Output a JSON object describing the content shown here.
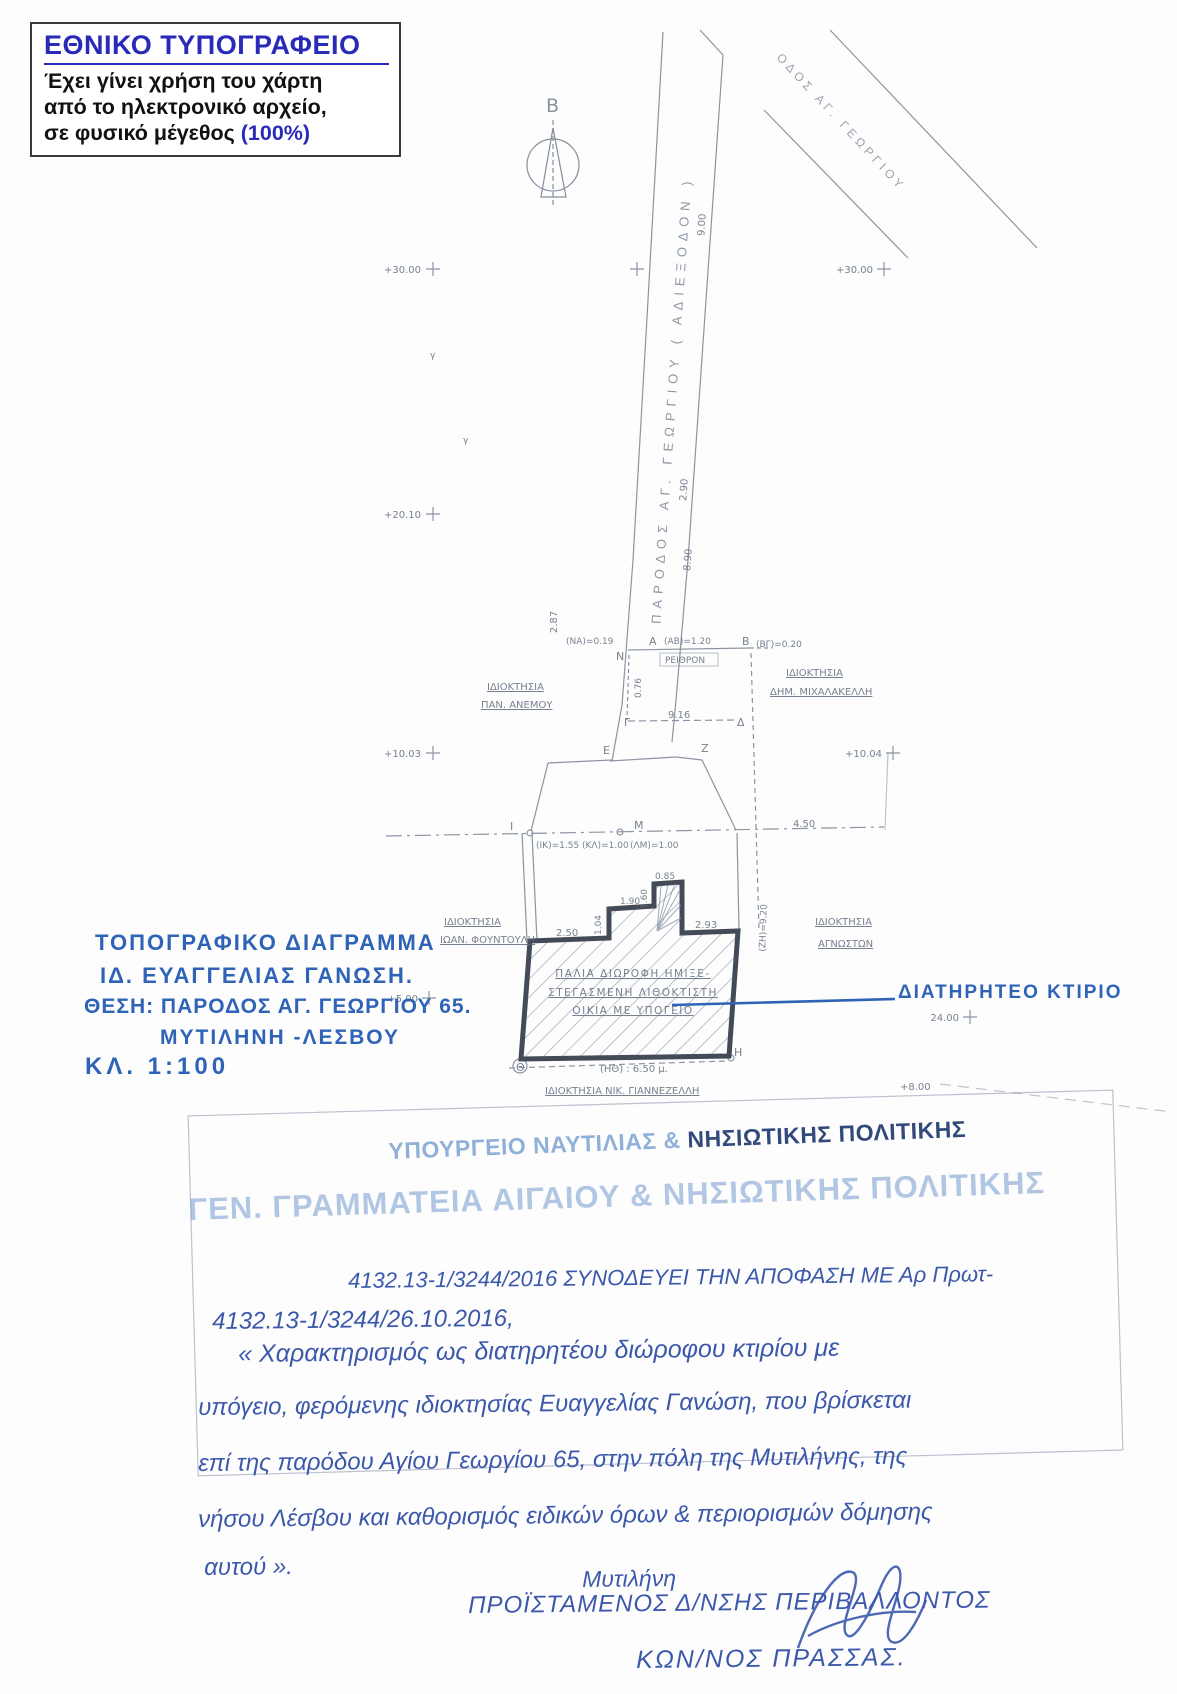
{
  "colors": {
    "header_blue": "#2a2ab8",
    "marker_blue": "#2e63b8",
    "ink_blue": "#3b58ab",
    "pencil_gray": "#6e7a8c",
    "stamp_faded": "#8fb0d8",
    "stamp_dark": "#32497b"
  },
  "header_box": {
    "title": "ΕΘΝΙΚΟ ΤΥΠΟΓΡΑΦΕΙΟ",
    "line1": "Έχει γίνει χρήση του χάρτη",
    "line2": "από το ηλεκτρονικό αρχείο,",
    "line3": "σε φυσικό μέγεθος ",
    "line3_highlight": "(100%)"
  },
  "north": {
    "label": "Β"
  },
  "drawing": {
    "road_main_label": "ΠΑΡΟΔΟΣ  ΑΓ. ΓΕΩΡΓΙΟΥ  ( ΑΔΙΕΞΟΔΟΝ )",
    "cross_road_label": "ΟΔΟΣ  ΑΓ. ΓΕΩΡΓΙΟΥ",
    "gutter_label": "ΡΕΙΘΡΟΝ",
    "owners": {
      "anemou_1": "ΙΔΙΟΚΤΗΣΙΑ",
      "anemou_2": "ΠΑΝ. ΑΝΕΜΟΥ",
      "michalakelli_1": "ΙΔΙΟΚΤΗΣΙΑ",
      "michalakelli_2": "ΔΗΜ. ΜΙΧΑΛΑΚΕΛΛΗ",
      "fountouli_1": "ΙΔΙΟΚΤΗΣΙΑ",
      "fountouli_2": "ΙΩΑΝ. ΦΟΥΝΤΟΥΛΗ",
      "agnoston_1": "ΙΔΙΟΚΤΗΣΙΑ",
      "agnoston_2": "ΑΓΝΩΣΤΩΝ",
      "giannezelli": "ΙΔΙΟΚΤΗΣΙΑ ΝΙΚ. ΓΙΑΝΝΕΖΕΛΛΗ"
    },
    "building_label_1": "ΠΑΛΙΑ ΔΙΩΡΟΦΗ ΗΜΙΞΕ-",
    "building_label_2": "ΣΤΕΓΑΣΜΕΝΗ ΛΙΘΟΚΤΙΣΤΗ",
    "building_label_3": "ΟΙΚΙΑ ΜΕ ΥΠΟΓΕΙΟ",
    "elevations": {
      "top_left": "+30.00",
      "top_right": "+30.00",
      "mid_left": "+20.10",
      "low_left": "+10.03",
      "low_right": "+10.04",
      "bottom_left": "+5.00",
      "bottom_right": "24.00",
      "far_right": "+8.00"
    },
    "points": {
      "n": "Ν",
      "a": "Α",
      "b": "Β",
      "g": "Γ",
      "d": "Δ",
      "e": "Ε",
      "z": "Ζ",
      "h": "Η",
      "th": "Θ",
      "i": "Ι",
      "m": "Μ"
    },
    "dims": {
      "w900": "9.00",
      "w290": "2.90",
      "w890": "8.90",
      "w287": "2.87",
      "w076": "0.76",
      "na": "(ΝΑ)=0.19",
      "ab": "(ΑΒ)=1.20",
      "bg": "(ΒΓ)=0.20",
      "w916": "9.16",
      "ik": "(ΙΚ)=1.55 (ΚΛ)=1.00",
      "lm": "(ΛΜ)=1.00",
      "w450": "4.50",
      "w250": "2.50",
      "w104": "1.04",
      "w190": "1.90",
      "w160": "1.60",
      "w085": "0.85",
      "w293": "2.93",
      "zh": "(ΖΗ)=9.20",
      "hth": "(ΗΘ) : 6.50 μ."
    }
  },
  "annotation": {
    "preserved_building": "ΔΙΑΤΗΡΗΤΕΟ ΚΤΙΡΙΟ"
  },
  "title_block": {
    "line1": "ΤΟΠΟΓΡΑΦΙΚΟ ΔΙΑΓΡΑΜΜΑ",
    "line2": "ΙΔ. ΕΥΑΓΓΕΛΙΑΣ ΓΑΝΩΣΗ.",
    "line3": "ΘΕΣΗ: ΠΑΡΟΔΟΣ ΑΓ. ΓΕΩΡΓΙΟΥ 65.",
    "line4": "ΜΥΤΙΛΗΝΗ -ΛΕΣΒΟΥ",
    "line5": "ΚΛ. 1:100"
  },
  "stamp": {
    "ministry_faded": "ΥΠΟΥΡΓΕΙΟ ΝΑΥΤΙΛΙΑΣ & ",
    "ministry_dark": "ΝΗΣΙΩΤΙΚΗΣ ΠΟΛΙΤΙΚΗΣ",
    "secretariat": "ΓΕΝ. ΓΡΑΜΜΑΤΕΙΑ ΑΙΓΑΙΟΥ & ΝΗΣΙΩΤΙΚΗΣ ΠΟΛΙΤΙΚΗΣ"
  },
  "handwritten": {
    "line1": "4132.13-1/3244/2016  ΣΥΝΟΔΕΥΕΙ ΤΗΝ ΑΠΟΦΑΣΗ ΜΕ Αρ Πρωτ-",
    "line2": "4132.13-1/3244/26.10.2016,",
    "line3": "« Χαρακτηρισμός ως διατηρητέου διώροφου κτιρίου με",
    "line4": "υπόγειο, φερόμενης ιδιοκτησίας Ευαγγελίας Γανώση, που βρίσκεται",
    "line5": "επί της παρόδου Αγίου Γεωργίου 65, στην πόλη της Μυτιλήνης, της",
    "line6": "νήσου Λέσβου και καθορισμός ειδικών όρων & περιορισμών δόμησης",
    "line7": "αυτού ».",
    "city": "Μυτιλήνη",
    "signer_title": "ΠΡΟΪΣΤΑΜΕΝΟΣ  Δ/ΝΣΗΣ  ΠΕΡΙΒΑΛΛΟΝΤΟΣ",
    "signer_name": "ΚΩΝ/ΝΟΣ  ΠΡΑΣΣΑΣ."
  }
}
